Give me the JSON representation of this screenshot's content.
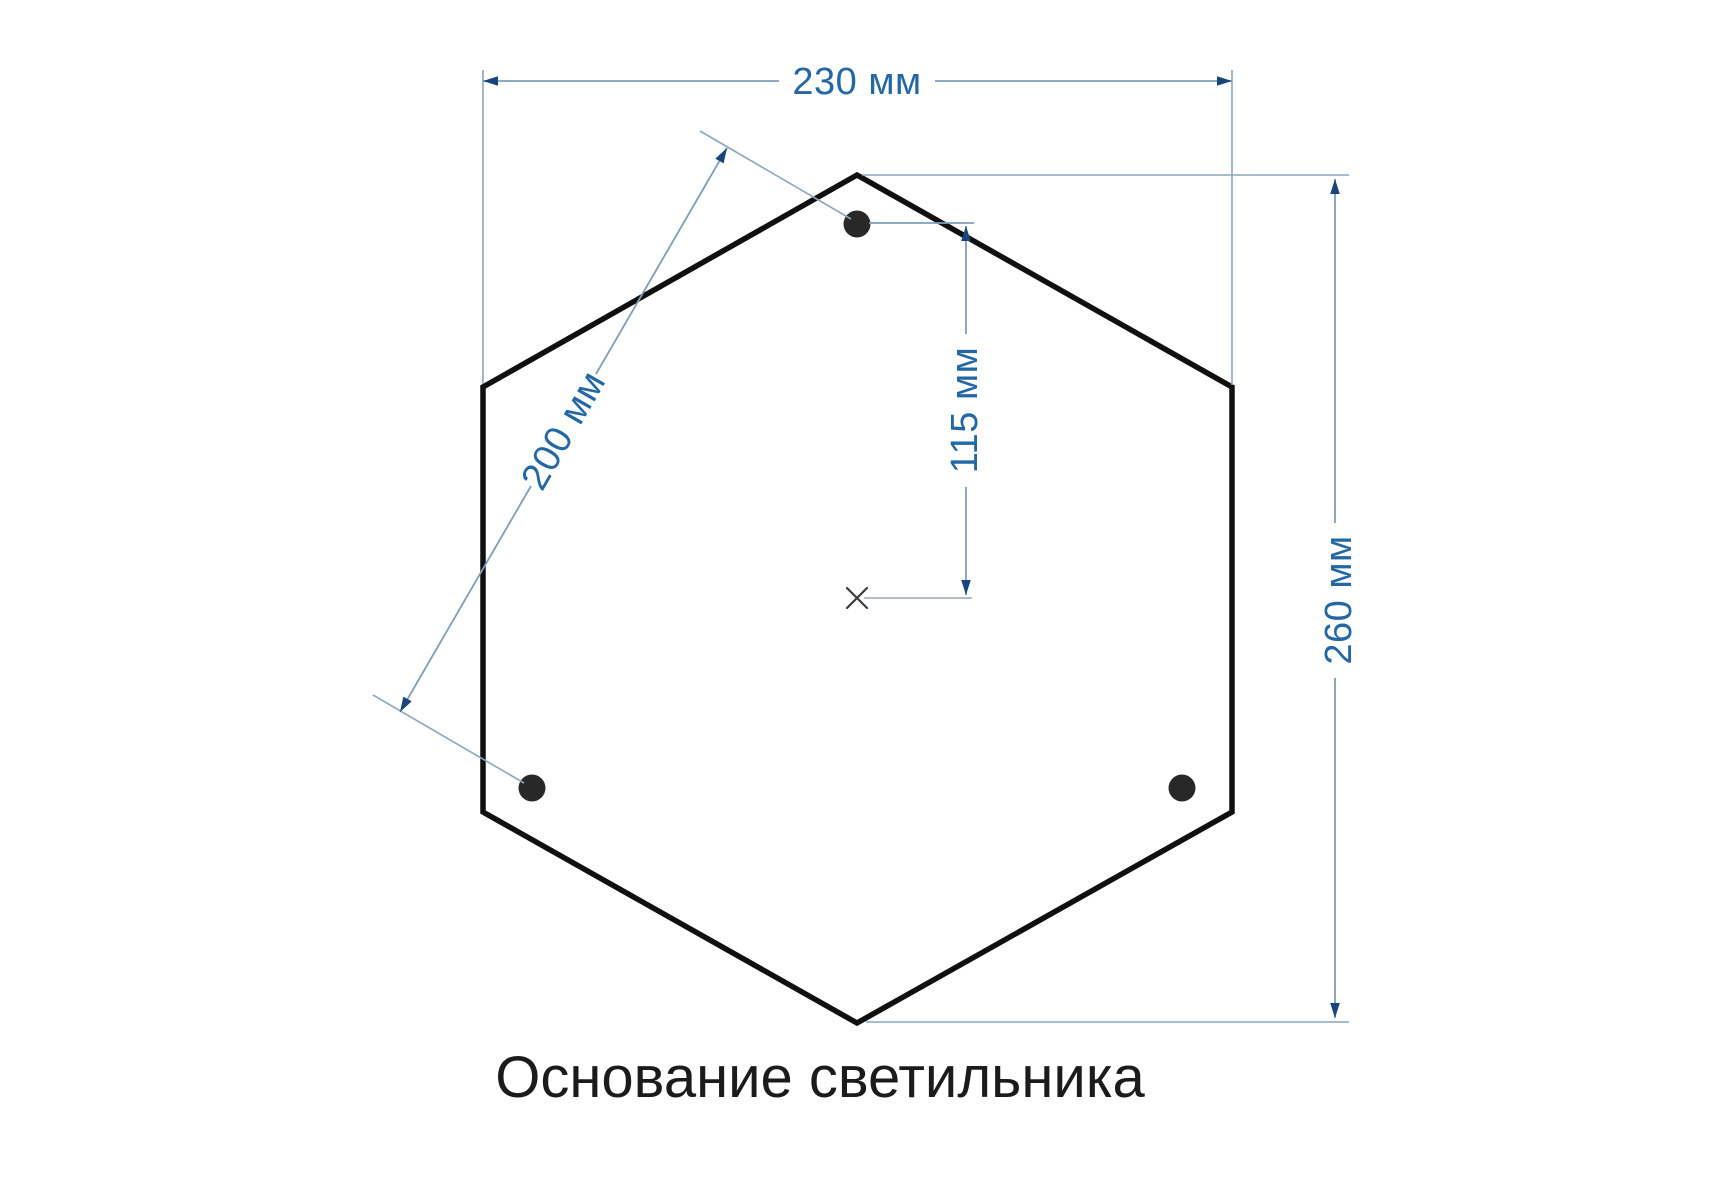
{
  "title": {
    "text": "Основание светильника"
  },
  "dimensions": {
    "width_label": "230 мм",
    "hole_spacing_label": "200 мм",
    "hole_offset_label": "115 мм",
    "height_label": "260 мм"
  },
  "shape": {
    "type": "hexagon",
    "holes_count": 3
  },
  "colors": {
    "outline": "#101010",
    "hole": "#282828",
    "dimension_line": "#7f9eba",
    "dimension_arrow": "#17457c",
    "dimension_text": "#2367a4",
    "title_text": "#1b1b1b",
    "background": "#ffffff"
  }
}
